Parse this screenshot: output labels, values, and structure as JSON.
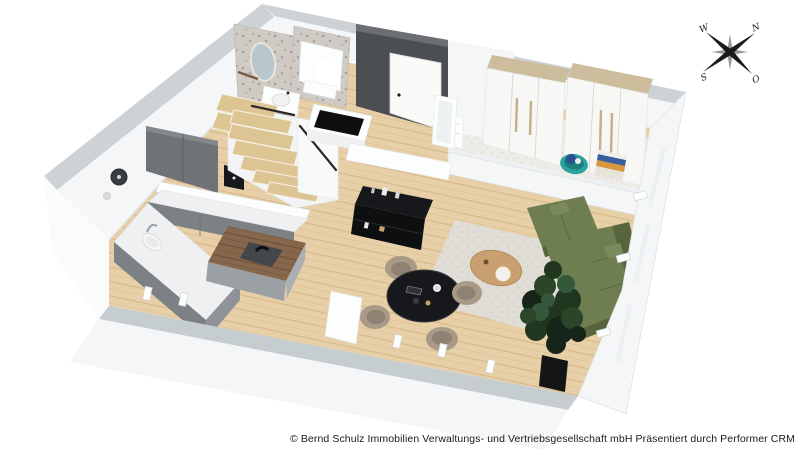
{
  "compass": {
    "north": "N",
    "south": "S",
    "west": "W",
    "east": "O"
  },
  "footer": {
    "credit": "© Bernd Schulz Immobilien Verwaltungs- und Vertriebsgesellschaft mbH Präsentiert durch Performer CRM"
  },
  "palette": {
    "bg": "#ffffff",
    "wall_top": "#ccd2d6",
    "wall_face": "#f4f6f7",
    "wall_shadow": "#dfe3e6",
    "floor_wood": "#e7cfa7",
    "island_wood": "#8a6a4e",
    "dark_wall": "#4b4e52",
    "cabinet_gray": "#7d8084",
    "counter_white": "#eef0f1",
    "sofa_green": "#6f7e50",
    "sofa_green_dark": "#57653e",
    "chair_beige": "#a89a87",
    "table_black": "#17181b",
    "plant_green": "#1f3322",
    "basket_teal": "#2aa3a0",
    "carpet": "#ecebe7",
    "rug": "#dedbd4",
    "terrazzo": "#cdc8c2",
    "wood_trim": "#cdbd9c",
    "text": "#1a1a1a"
  },
  "scene": {
    "type": "3d-floorplan-render",
    "rooms": [
      "bathroom",
      "entrance",
      "dressing-area",
      "kitchen",
      "stairs",
      "living-dining-area"
    ],
    "objects": [
      "oval-mirror",
      "washbasin",
      "shower",
      "entrance-door",
      "radiator",
      "floor-mirror",
      "wardrobe",
      "wardrobe",
      "teal-basket",
      "folded-clothes",
      "wall-clock",
      "upper-cabinets",
      "kitchen-counter",
      "kitchen-sink",
      "coffee-machine",
      "kitchen-island-with-hob",
      "winder-staircase",
      "console-with-black-top",
      "media-sideboard",
      "round-dining-table",
      "dining-chairs-x4",
      "oval-coffee-table",
      "corner-sofa-green",
      "potted-plant"
    ]
  }
}
